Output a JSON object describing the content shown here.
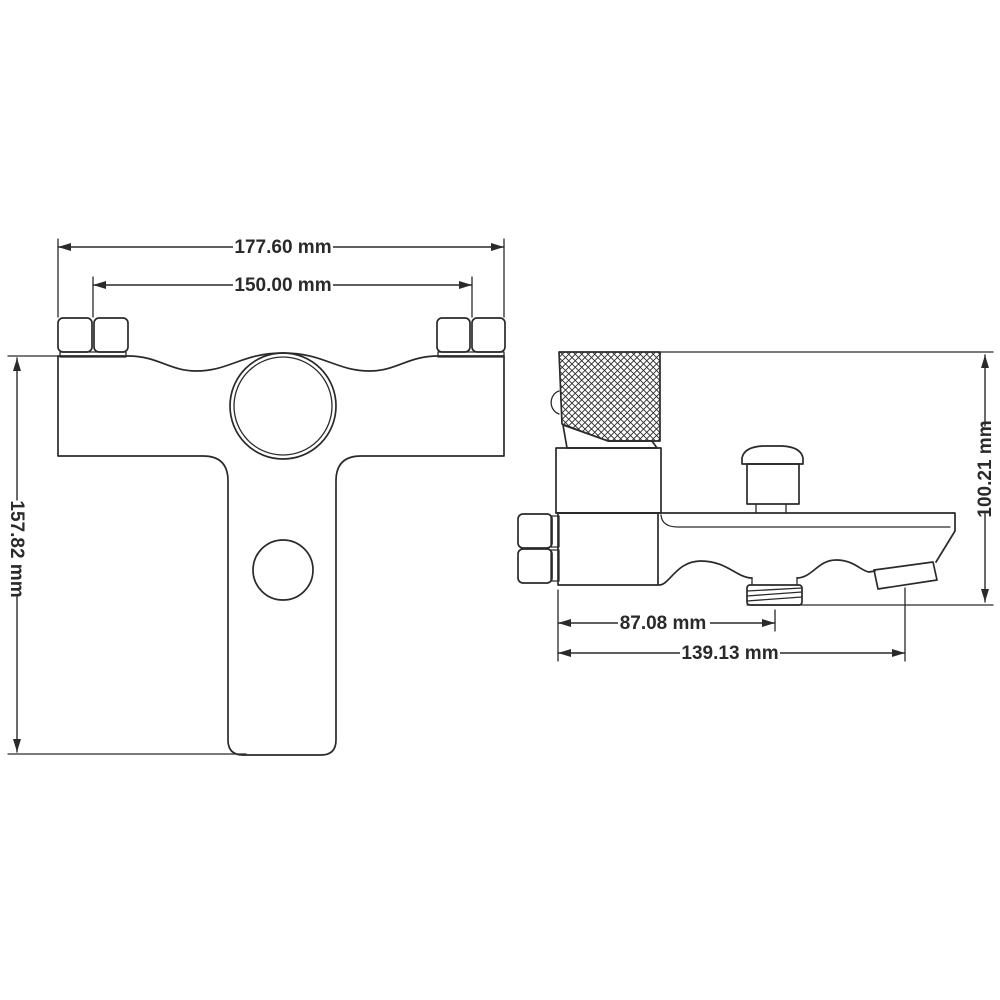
{
  "drawing": {
    "type": "technical-dimension-drawing",
    "subject": "wall-mounted bath mixer faucet, front view and side view",
    "views": {
      "front_view": "T-shaped faucet body with two mounting nuts, large mixer cartridge circle and lower handle circle",
      "side_view": "knurled handle on top, diverter knob, spout with threaded shower outlet and angled tip"
    }
  },
  "dimensions": {
    "front_outer_width": "177.60 mm",
    "front_inner_width": "150.00 mm",
    "front_height": "157.82 mm",
    "side_height": "100.21 mm",
    "side_outlet_offset": "87.08 mm",
    "side_overall_length": "139.13 mm"
  },
  "colors": {
    "line": "#2a2a2a",
    "background": "#ffffff"
  }
}
